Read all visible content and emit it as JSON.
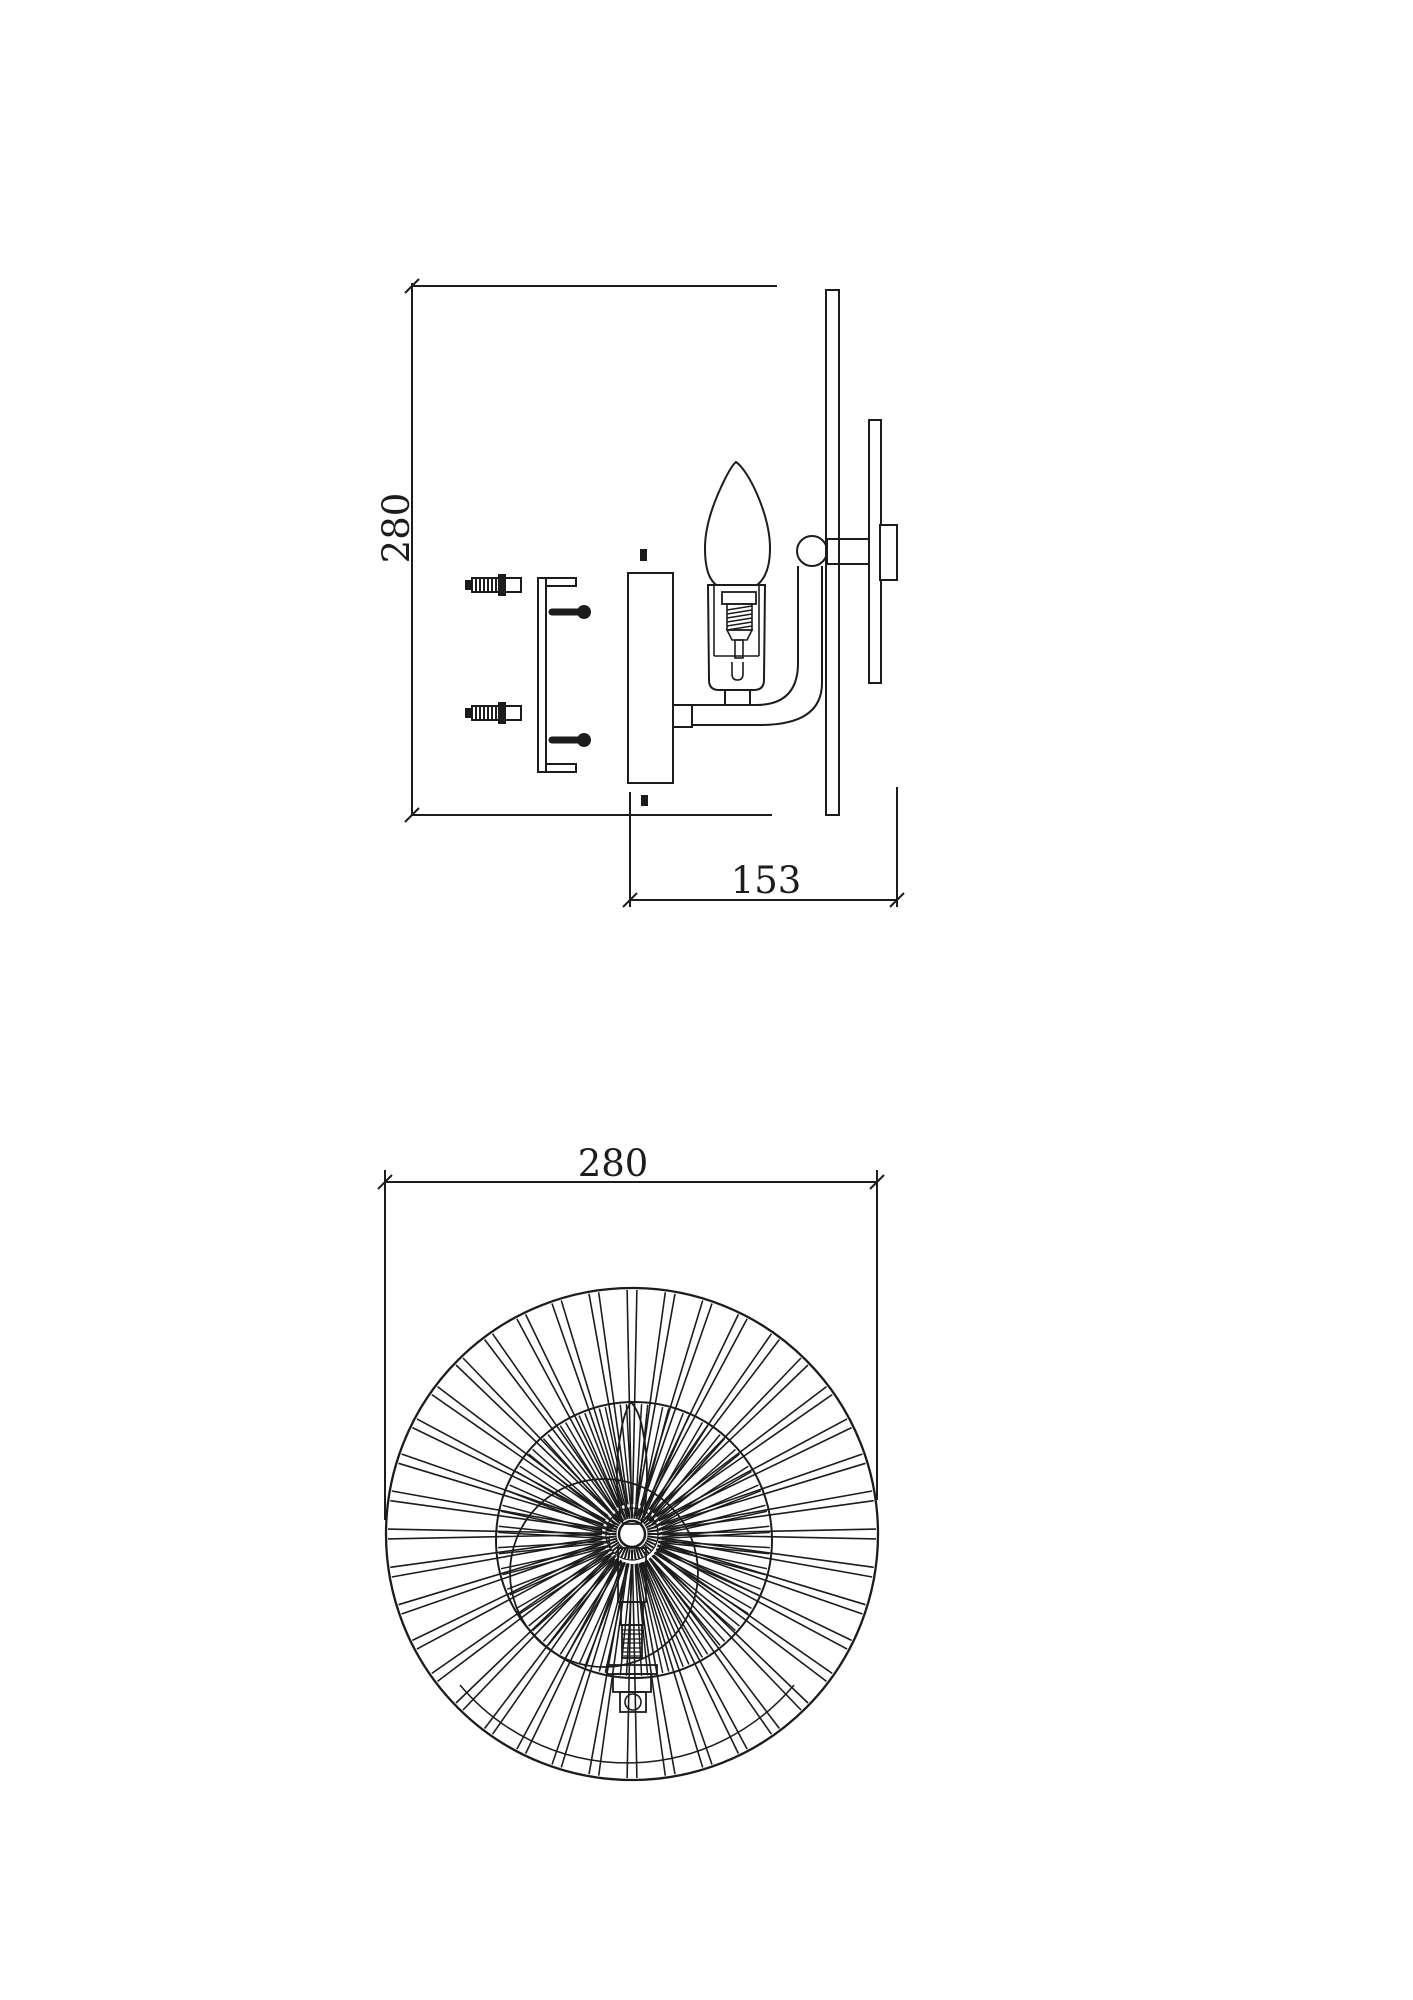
{
  "page": {
    "background": "#ffffff",
    "ink": "#1c1c1c",
    "title": "wall-lamp-dimension-drawing"
  },
  "side_view": {
    "height_dim": "280",
    "depth_dim": "153",
    "parts": {
      "anchor": "wall-anchor",
      "bracket": "mounting-bracket",
      "screw": "mounting-screw",
      "backplate": "wall-backplate",
      "arm": "curved-arm",
      "bulb": "candle-bulb",
      "socket": "lamp-socket",
      "ball": "ball-joint",
      "disc": "wire-disc-shade-edge",
      "inner_disc": "inner-disc-edge",
      "finial": "wall-finial-cup"
    }
  },
  "front_view": {
    "width_dim": "280",
    "spokes": {
      "outer_pairs": 40,
      "inner_pairs": 40,
      "hub_ticks": 44
    }
  }
}
